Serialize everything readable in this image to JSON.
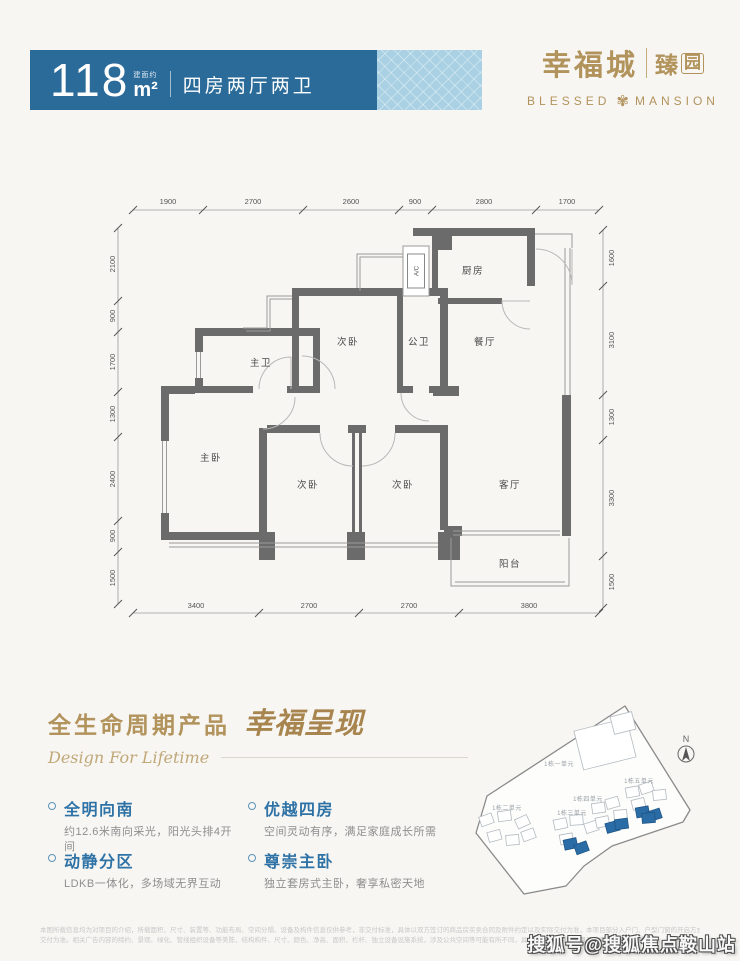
{
  "header": {
    "area_value": "118",
    "area_note": "建面约",
    "area_unit": "m²",
    "layout": "四房两厅两卫"
  },
  "logo": {
    "name_cn": "幸福城",
    "sub_char1": "臻",
    "sub_char2": "园",
    "en_left": "BLESSED",
    "en_right": "MANSION",
    "medal_icon": "✾"
  },
  "floorplan": {
    "rooms": {
      "kitchen": "厨房",
      "bedroom_top": "次卧",
      "public_bath": "公卫",
      "dining": "餐厅",
      "master_bath": "主卫",
      "master_bed": "主卧",
      "bedroom_left": "次卧",
      "bedroom_right": "次卧",
      "living": "客厅",
      "balcony": "阳台",
      "ac": "A/C"
    },
    "dims_top": [
      "1900",
      "2700",
      "2600",
      "900",
      "2800",
      "1700"
    ],
    "dims_bottom": [
      "3400",
      "2700",
      "2700",
      "3800"
    ],
    "dims_left": [
      "2100",
      "900",
      "1700",
      "1300",
      "2400",
      "900",
      "1500"
    ],
    "dims_right": [
      "1600",
      "3100",
      "1300",
      "3300",
      "1500"
    ]
  },
  "promo": {
    "title": "全生命周期产品",
    "title_script": "幸福呈现",
    "subtitle": "Design For Lifetime"
  },
  "features": [
    {
      "title": "全明向南",
      "desc": "约12.6米南向采光，阳光头排4开间"
    },
    {
      "title": "优越四房",
      "desc": "空间灵动有序，满足家庭成长所需"
    },
    {
      "title": "动静分区",
      "desc": "LDKB一体化，多场域无界互动"
    },
    {
      "title": "尊崇主卧",
      "desc": "独立套房式主卧，奢享私密天地"
    }
  ],
  "sitemap": {
    "north": "N",
    "units": [
      "1栋一单元",
      "1栋二单元",
      "1栋三单元",
      "1栋四单元",
      "1栋五单元"
    ]
  },
  "disclaimer": {
    "line1": "本图所载信息均为对项目的介绍，所载面积、尺寸、装置等、功能布局、空间分隔、设备及构件信息仅供参考，非交付标准，具体以双方签订的商品房买卖合同及附件约定以及实际交付为准，本项目部分入户门、户型门窗的开启方式方向及小区大小位置为示意图，最终以实际交付及相关批文为准。",
    "line2": "交付为准。相关广告内容的缔约、景观、绿化、管线组织设备等美陈、结构构件、尺寸、颜色、净高、面积、栏杆、独立设备设施系统，涉及公共空间等可能有所不同，具体以实际交付的项目及政府最终审批文件为准。"
  },
  "watermark": "搜狐号@搜狐焦点鞍山站",
  "colors": {
    "banner_blue": "#2b6b9a",
    "banner_light": "#a9d1e3",
    "gold": "#b2935c",
    "feature_blue": "#2e72a6",
    "site_highlight": "#2a6ca6",
    "wall_gray": "#6b6b6b"
  }
}
